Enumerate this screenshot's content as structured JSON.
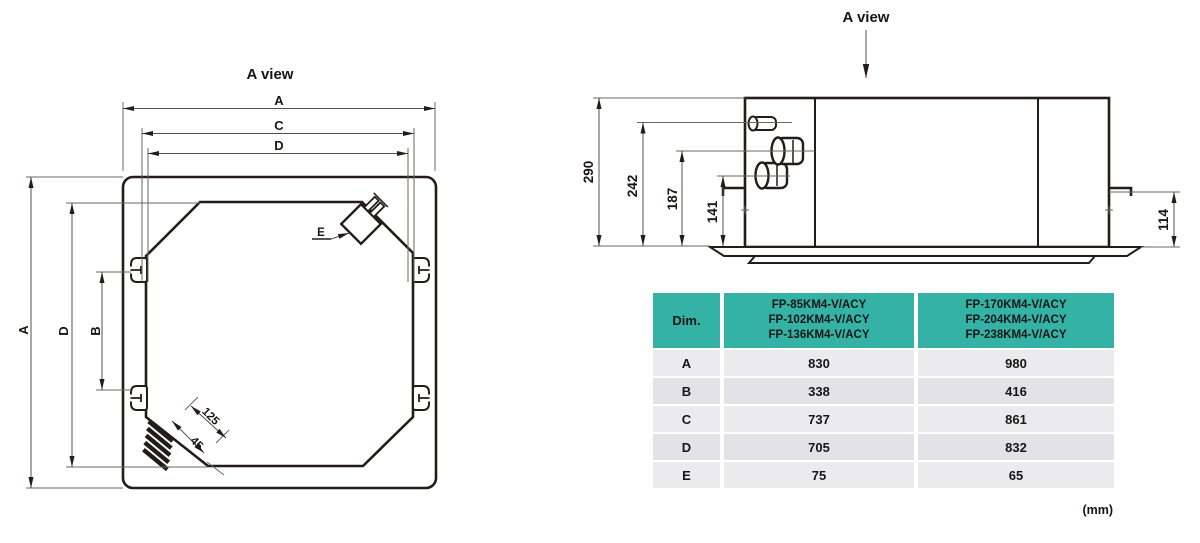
{
  "document": {
    "unit_note": "(mm)"
  },
  "plan_view": {
    "title": "A view",
    "dim_labels": {
      "a": "A",
      "b": "B",
      "c": "C",
      "d": "D",
      "e": "E"
    },
    "pipe_dims": {
      "length": "125",
      "offset": "45"
    }
  },
  "side_view": {
    "title": "A view",
    "heights": {
      "total": "290",
      "drain": "242",
      "pipe_high": "187",
      "pipe_low": "141",
      "panel": "114"
    }
  },
  "table": {
    "header": {
      "dim": "Dim.",
      "group1": [
        "FP-85KM4-V/ACY",
        "FP-102KM4-V/ACY",
        "FP-136KM4-V/ACY"
      ],
      "group2": [
        "FP-170KM4-V/ACY",
        "FP-204KM4-V/ACY",
        "FP-238KM4-V/ACY"
      ]
    },
    "rows": [
      {
        "dim": "A",
        "g1": "830",
        "g2": "980"
      },
      {
        "dim": "B",
        "g1": "338",
        "g2": "416"
      },
      {
        "dim": "C",
        "g1": "737",
        "g2": "861"
      },
      {
        "dim": "D",
        "g1": "705",
        "g2": "832"
      },
      {
        "dim": "E",
        "g1": "75",
        "g2": "65"
      }
    ]
  },
  "colors": {
    "header_teal": "#35b2a6",
    "row_light": "#ebebed",
    "row_dark": "#e3e3e7",
    "line_dark": "#241c18"
  }
}
